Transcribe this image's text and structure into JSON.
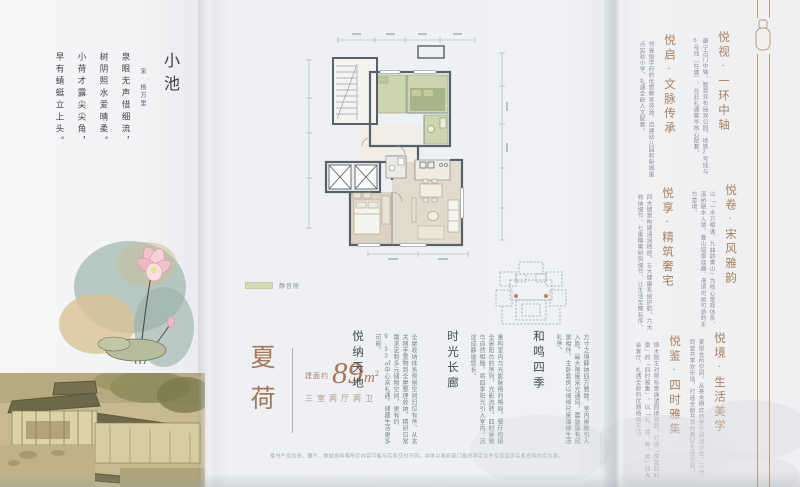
{
  "poem": {
    "title": "小池",
    "author": "宋·杨万里",
    "lines": [
      "泉眼无声惜细流，",
      "树阴照水爱晴柔。",
      "小荷才露尖尖角，",
      "早有蜻蜓立上头。"
    ]
  },
  "unit": {
    "name": "夏荷",
    "area_prefix": "建面约",
    "area": "89",
    "area_unit": "m",
    "area_sup": "2",
    "layout": "三室两厅两卫"
  },
  "legend": {
    "label": "静音舱"
  },
  "features": [
    {
      "title": "悦纳天地",
      "body": "全屋收纳体系预留空间归位有序，从玄关随手置物到全屋整理收纳，精研日常需求定制多元储物空间，更有约9.33㎡中心亲礼遇，储藏生活更多可能。"
    },
    {
      "title": "时光长廊",
      "body": "重构室内与光影脉络的格局，餐厅衔接全景阳台的序列，光影流转，四时景致与自然相融，将四季阳光引入室内，沉淀成静谧悠长。"
    },
    {
      "title": "和鸣四季",
      "body": "方寸之境静纳四方雅致，室内景致引人入胜，最大限度采光通风，晨昏皆有风景相伴，主卧套房以阔绰尺度演绎生活礼序。"
    }
  ],
  "highlights": [
    {
      "title": "悦启·文脉传承",
      "body": "邻省级学府的优质教育资源，自建幼儿园和新城重点实验小学，礼遇全龄人文配套。"
    },
    {
      "title": "悦视·一环中轴",
      "body": "康宁古门中轴，智慧双布局双公园，地铁2号线与5号线（在建），在此礼遇繁华核心配套。"
    },
    {
      "title": "悦享·精筑奢宅",
      "body": "四大镜景构建浸润栖居，五大健康系统护航，六大收纳细节，七重精奢研筑细节，让生活至臻有序。"
    },
    {
      "title": "悦卷·宋风雅韵",
      "body": "以「一水万相逢，九曲韵青山」为核心景观体系，溪桥融水入境，叠山错景成趣，漫境可居可游的东方意境。"
    },
    {
      "title": "悦鉴·四时雅集",
      "body": "择木院生对称布景遥望园境雅韵，打造「悦赏四时景」的「四时雅集」，以「礼、境、养、智」四大会客厅，礼遇全龄的优雅栖居生活。"
    },
    {
      "title": "悦境·生活美学",
      "body": "宴悦会所空间，从茶舍棋弈到亲子阅读沙龙，三代同堂共享欢乐场，打造全龄共享的美好生活空间。"
    }
  ],
  "disclaimer": "楼书产品信息、图片、数据资料等所示内容可能与实际交付不同，具体以政府部门最终审定文件及商品房买卖合同约定为准。",
  "colors": {
    "accent_gold": "#a5795a",
    "plan_green": "#cdd5b0",
    "plan_green_dark": "#a9b488",
    "plan_wall": "#596069",
    "plan_floor": "#dbd2c2"
  }
}
